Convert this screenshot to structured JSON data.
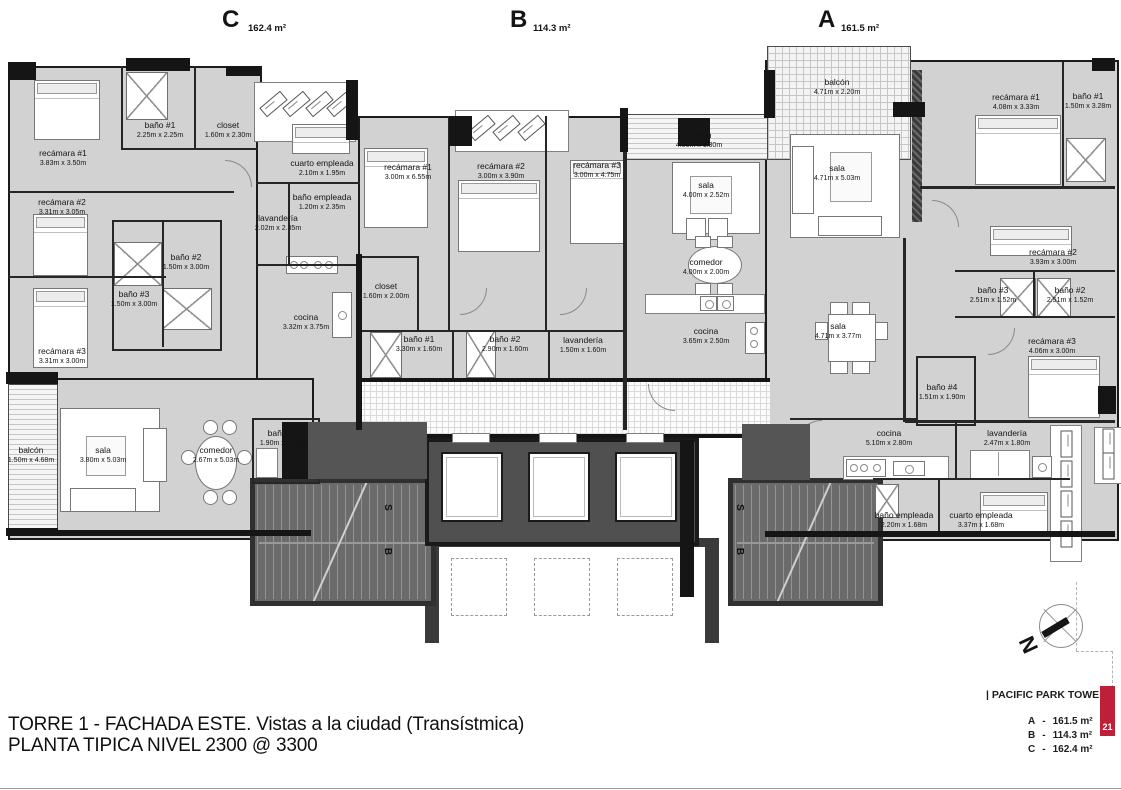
{
  "sections": {
    "c": {
      "letter": "C",
      "area": "162.4 m²"
    },
    "b": {
      "letter": "B",
      "area": "114.3 m²"
    },
    "a": {
      "letter": "A",
      "area": "161.5 m²"
    }
  },
  "units": {
    "c": {
      "recamara1": {
        "name": "recámara #1",
        "dims": "3.83m x 3.50m"
      },
      "bano1": {
        "name": "baño #1",
        "dims": "2.25m x 2.25m"
      },
      "closet1": {
        "name": "closet",
        "dims": "1.60m x 2.30m"
      },
      "recamara2": {
        "name": "recámara #2",
        "dims": "3.31m x 3.05m"
      },
      "bano2": {
        "name": "baño #2",
        "dims": "1.50m x 3.00m"
      },
      "bano3": {
        "name": "baño #3",
        "dims": "1.50m x 3.00m"
      },
      "recamara3": {
        "name": "recámara #3",
        "dims": "3.31m x 3.00m"
      },
      "cuarto_empleada": {
        "name": "cuarto empleada",
        "dims": "2.10m x 1.95m"
      },
      "bano_empleada": {
        "name": "baño empleada",
        "dims": "1.20m x 2.35m"
      },
      "lavanderia": {
        "name": "lavandería",
        "dims": "2.02m x 2.35m"
      },
      "cocina": {
        "name": "cocina",
        "dims": "3.32m x 3.75m"
      },
      "closet2": {
        "name": "closet",
        "dims": "1.60m x 2.00m"
      },
      "balcon": {
        "name": "balcón",
        "dims": "1.50m x 4.68m"
      },
      "sala": {
        "name": "sala",
        "dims": "3.80m x 5.03m"
      },
      "comedor": {
        "name": "comedor",
        "dims": "2.67m x 5.03m"
      },
      "bano4": {
        "name": "baño #4",
        "dims": "1.90m x 1.55m"
      }
    },
    "b": {
      "recamara1": {
        "name": "recámara #1",
        "dims": "3.00m x 6.55m"
      },
      "recamara2": {
        "name": "recámara #2",
        "dims": "3.00m x 3.90m"
      },
      "recamara3": {
        "name": "recámara #3",
        "dims": "3.00m x 4.75m"
      },
      "balcon": {
        "name": "balcón",
        "dims": "4.00m x 1.30m"
      },
      "sala": {
        "name": "sala",
        "dims": "4.00m x 2.52m"
      },
      "comedor": {
        "name": "comedor",
        "dims": "4.00m x 2.00m"
      },
      "cocina": {
        "name": "cocina",
        "dims": "3.65m x 2.50m"
      },
      "bano1": {
        "name": "baño #1",
        "dims": "3.30m x 1.60m"
      },
      "bano2": {
        "name": "baño #2",
        "dims": "2.90m x 1.60m"
      },
      "lavanderia": {
        "name": "lavandería",
        "dims": "1.50m x 1.60m"
      }
    },
    "a": {
      "balcon": {
        "name": "balcón",
        "dims": "4.71m x 2.20m"
      },
      "sala": {
        "name": "sala",
        "dims": "4.71m x 5.03m"
      },
      "recamara1": {
        "name": "recámara #1",
        "dims": "4.08m x 3.33m"
      },
      "bano1": {
        "name": "baño #1",
        "dims": "1.50m x 3.28m"
      },
      "recamara2": {
        "name": "recámara #2",
        "dims": "3.93m x 3.00m"
      },
      "bano3": {
        "name": "baño #3",
        "dims": "2.51m x 1.52m"
      },
      "bano2": {
        "name": "baño #2",
        "dims": "2.51m x 1.52m"
      },
      "recamara3": {
        "name": "recámara #3",
        "dims": "4.06m x 3.00m"
      },
      "bano4": {
        "name": "baño #4",
        "dims": "1.51m x 1.90m"
      },
      "sala2": {
        "name": "sala",
        "dims": "4.71m x 3.77m"
      },
      "cocina": {
        "name": "cocina",
        "dims": "5.10m x 2.80m"
      },
      "lavanderia": {
        "name": "lavandería",
        "dims": "2.47m x 1.80m"
      },
      "bano_empleada": {
        "name": "baño empleada",
        "dims": "2.20m x 1.68m"
      },
      "cuarto_empleada": {
        "name": "cuarto empleada",
        "dims": "3.37m x 1.68m"
      }
    }
  },
  "core": {
    "stair_up": "S",
    "stair_down": "B"
  },
  "compass": {
    "north": "N"
  },
  "footer": {
    "line1": "TORRE 1 - FACHADA ESTE. Vistas a la ciudad (Transístmica)",
    "line2": "PLANTA TIPICA NIVEL 2300 @ 3300"
  },
  "legend": {
    "brand": "| PACIFIC PARK TOWERS",
    "separator": "-",
    "rows": [
      {
        "unit": "A",
        "area": "161.5 m²"
      },
      {
        "unit": "B",
        "area": "114.3 m²"
      },
      {
        "unit": "C",
        "area": "162.4 m²"
      }
    ],
    "page": "21",
    "accent_color": "#be2039"
  }
}
